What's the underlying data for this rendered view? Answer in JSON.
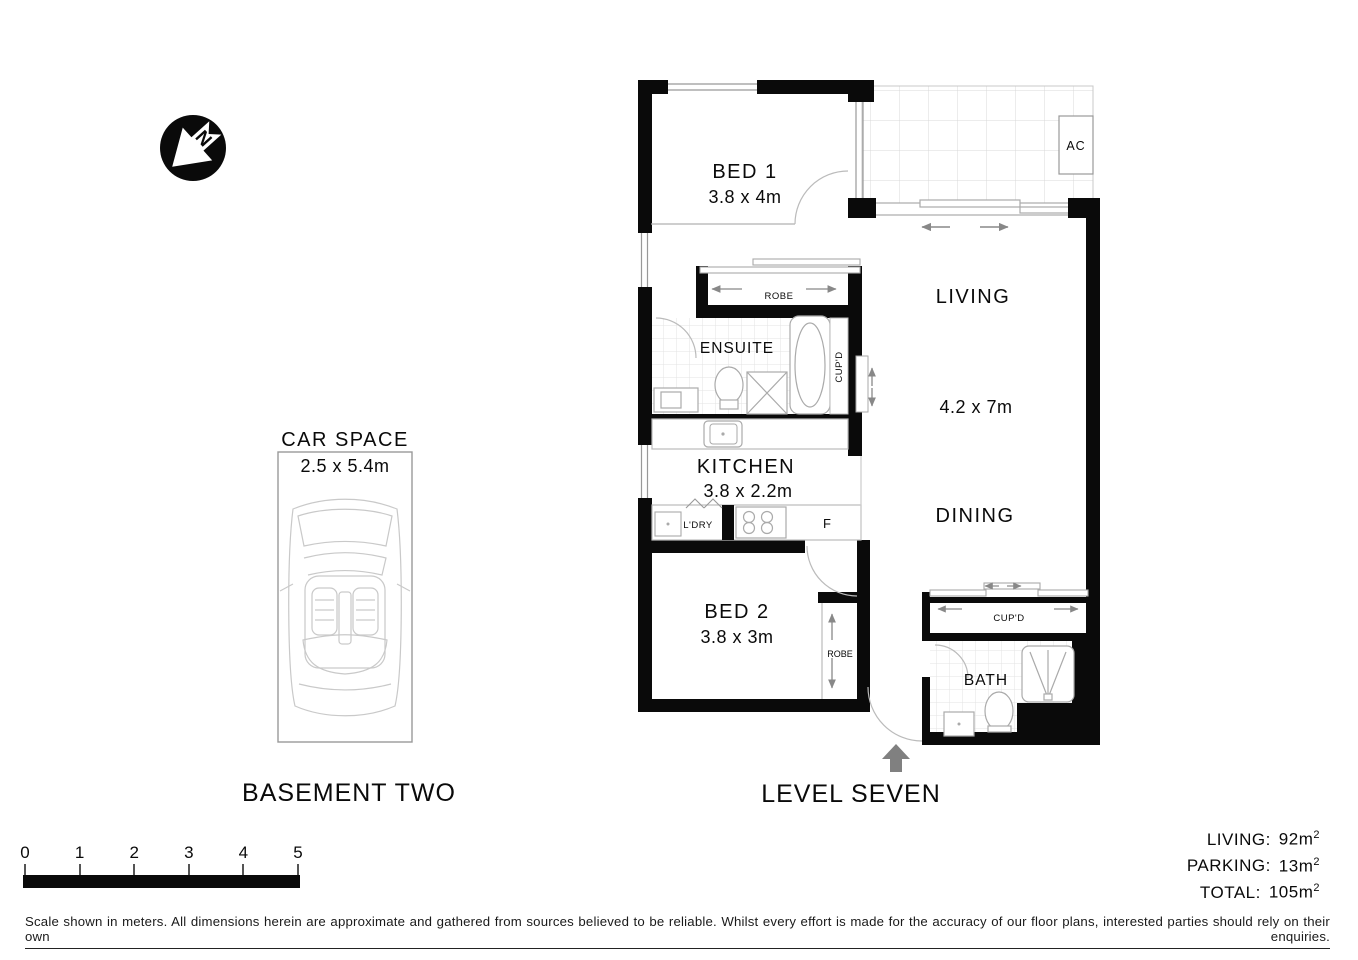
{
  "north_arrow": {
    "label": "N"
  },
  "basement": {
    "title": "BASEMENT TWO",
    "car_space": {
      "title": "CAR SPACE",
      "dimensions": "2.5 x 5.4m"
    }
  },
  "level": {
    "title": "LEVEL SEVEN",
    "rooms": {
      "bed1": {
        "name": "BED 1",
        "dimensions": "3.8 x 4m"
      },
      "living": {
        "name": "LIVING",
        "dimensions": "4.2 x 7m"
      },
      "dining": {
        "name": "DINING"
      },
      "kitchen": {
        "name": "KITCHEN",
        "dimensions": "3.8 x 2.2m"
      },
      "bed2": {
        "name": "BED 2",
        "dimensions": "3.8 x 3m"
      },
      "ensuite": {
        "name": "ENSUITE"
      },
      "bath": {
        "name": "BATH"
      },
      "robe_bed1": {
        "name": "ROBE"
      },
      "robe_bed2": {
        "name": "ROBE"
      },
      "laundry": {
        "name": "L'DRY"
      },
      "fridge": {
        "name": "F"
      },
      "cupboard_hall": {
        "name": "CUP'D"
      },
      "cupboard_dining": {
        "name": "CUP'D"
      },
      "air_conditioner": {
        "name": "AC"
      }
    }
  },
  "areas": {
    "rows": [
      {
        "label": "LIVING:",
        "value": "92m",
        "superscript": "2"
      },
      {
        "label": "PARKING:",
        "value": "13m",
        "superscript": "2"
      },
      {
        "label": "TOTAL:",
        "value": "105m",
        "superscript": "2"
      }
    ]
  },
  "scale_bar": {
    "ticks": [
      "0",
      "1",
      "2",
      "3",
      "4",
      "5"
    ]
  },
  "disclaimer": "Scale shown in meters. All dimensions herein are approximate and gathered from sources believed to be  reliable. Whilst every effort is made for the accuracy of our floor plans, interested parties should rely on their own enquiries.",
  "colors": {
    "wall": "#0a0a0a",
    "arrow_gray": "#888888",
    "fixture_gray": "#aaaaaa",
    "tile_gray": "#e3e3e3",
    "entry_arrow": "#808080"
  }
}
